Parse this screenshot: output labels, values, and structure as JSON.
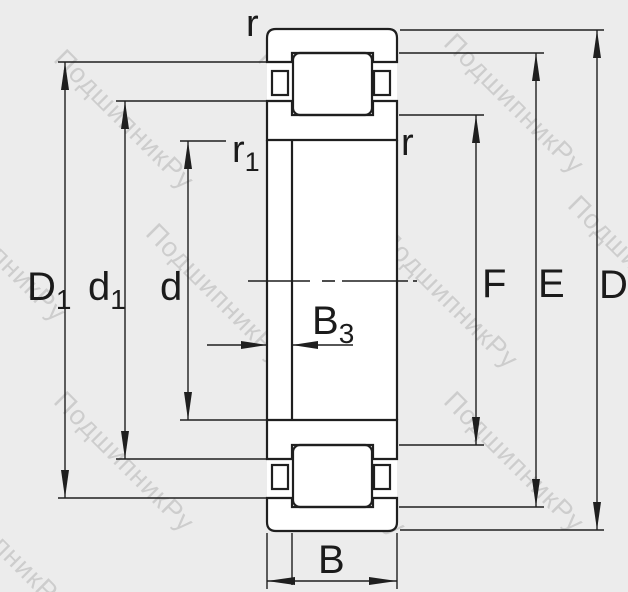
{
  "watermark": {
    "text": "ПодшипникРу"
  },
  "labels": {
    "r_top": "r",
    "r_right": "r",
    "r1": {
      "main": "r",
      "sub": "1"
    },
    "D1": {
      "main": "D",
      "sub": "1"
    },
    "d1": {
      "main": "d",
      "sub": "1"
    },
    "d": "d",
    "B3": {
      "main": "B",
      "sub": "3"
    },
    "B": "B",
    "F": "F",
    "E": "E",
    "D": "D"
  },
  "colors": {
    "background": "#ececec",
    "line": "#1f1f1f",
    "label": "#1b1b1b",
    "watermark": "#b9b9b9"
  }
}
